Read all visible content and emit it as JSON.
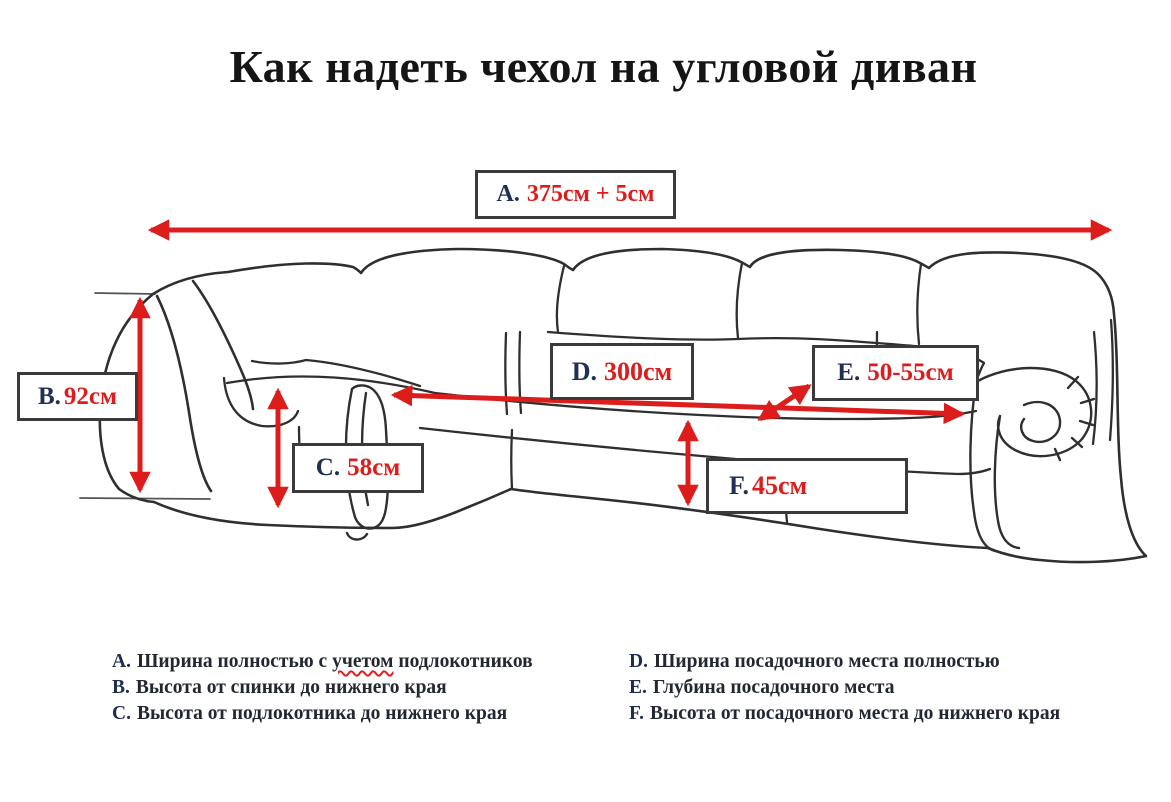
{
  "title": "Как надеть чехол на угловой диван",
  "colors": {
    "accent_red": "#dd1c1c",
    "letter_navy": "#203055",
    "sketch_line": "#2f2f2f"
  },
  "measurements": {
    "A": {
      "letter": "A.",
      "value": "375см + 5см"
    },
    "B": {
      "letter": "B.",
      "value": "92см"
    },
    "C": {
      "letter": "C.",
      "value": "58см"
    },
    "D": {
      "letter": "D.",
      "value": "300см"
    },
    "E": {
      "letter": "E.",
      "value": "50-55см"
    },
    "F": {
      "letter": "F.",
      "value": "45см"
    }
  },
  "legend": {
    "left": [
      {
        "letter": "A.",
        "pre": "Ширина полностью с ",
        "misspelled": "учетом",
        "post": " подлокотников"
      },
      {
        "letter": "B.",
        "text": "Высота от спинки до нижнего края"
      },
      {
        "letter": "C.",
        "text": "Высота от подлокотника до нижнего края"
      }
    ],
    "right": [
      {
        "letter": "D.",
        "text": "Ширина посадочного места полностью"
      },
      {
        "letter": "E.",
        "text": "Глубина посадочного места"
      },
      {
        "letter": "F.",
        "text": "Высота от посадочного места до нижнего края"
      }
    ]
  }
}
